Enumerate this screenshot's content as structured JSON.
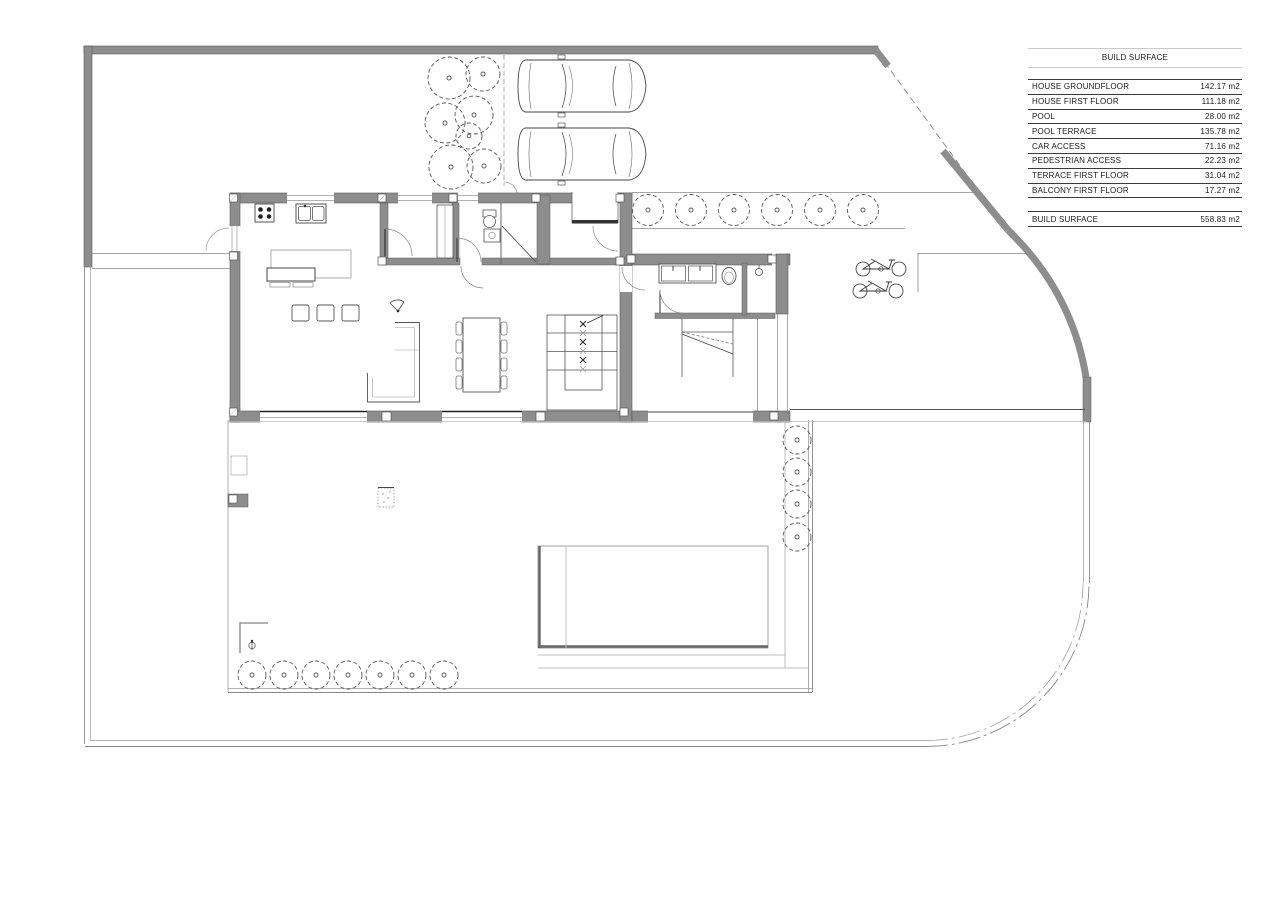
{
  "colors": {
    "background": "#ffffff",
    "wall_fill": "#8d8d8d",
    "wall_edge": "#5a5a5a",
    "line_dark": "#444444",
    "line_mid": "#777777",
    "line_light": "#aaaaaa",
    "text": "#1a1a1a",
    "rule_light": "#c9c9c9",
    "rule_dark": "#3a3a3a"
  },
  "surface_table": {
    "title": "BUILD SURFACE",
    "rows": [
      {
        "label": "HOUSE GROUNDFLOOR",
        "value": "142.17 m2"
      },
      {
        "label": "HOUSE FIRST FLOOR",
        "value": "111.18 m2"
      },
      {
        "label": "POOL",
        "value": "28.00 m2"
      },
      {
        "label": "POOL TERRACE",
        "value": "135.78 m2"
      },
      {
        "label": "CAR ACCESS",
        "value": "71.16 m2"
      },
      {
        "label": "PEDESTRIAN ACCESS",
        "value": "22.23 m2"
      },
      {
        "label": "TERRACE FIRST FLOOR",
        "value": "31.04 m2"
      },
      {
        "label": "BALCONY FIRST FLOOR",
        "value": "17.27 m2"
      }
    ],
    "total": {
      "label": "BUILD SURFACE",
      "value": "558.83 m2"
    }
  },
  "plan": {
    "icons": {
      "tree": "dashed circle with center dot",
      "car": "top-view outline",
      "bicycle": "side-view outline",
      "stove": "square with 4 burners",
      "kitchen-sink": "double bowl",
      "toilet": "ellipse with tank",
      "washbasin": "rect with bowl",
      "shower": "circle head",
      "garden-lamp": "circle on stem",
      "stairs": "treads with cut line"
    }
  }
}
